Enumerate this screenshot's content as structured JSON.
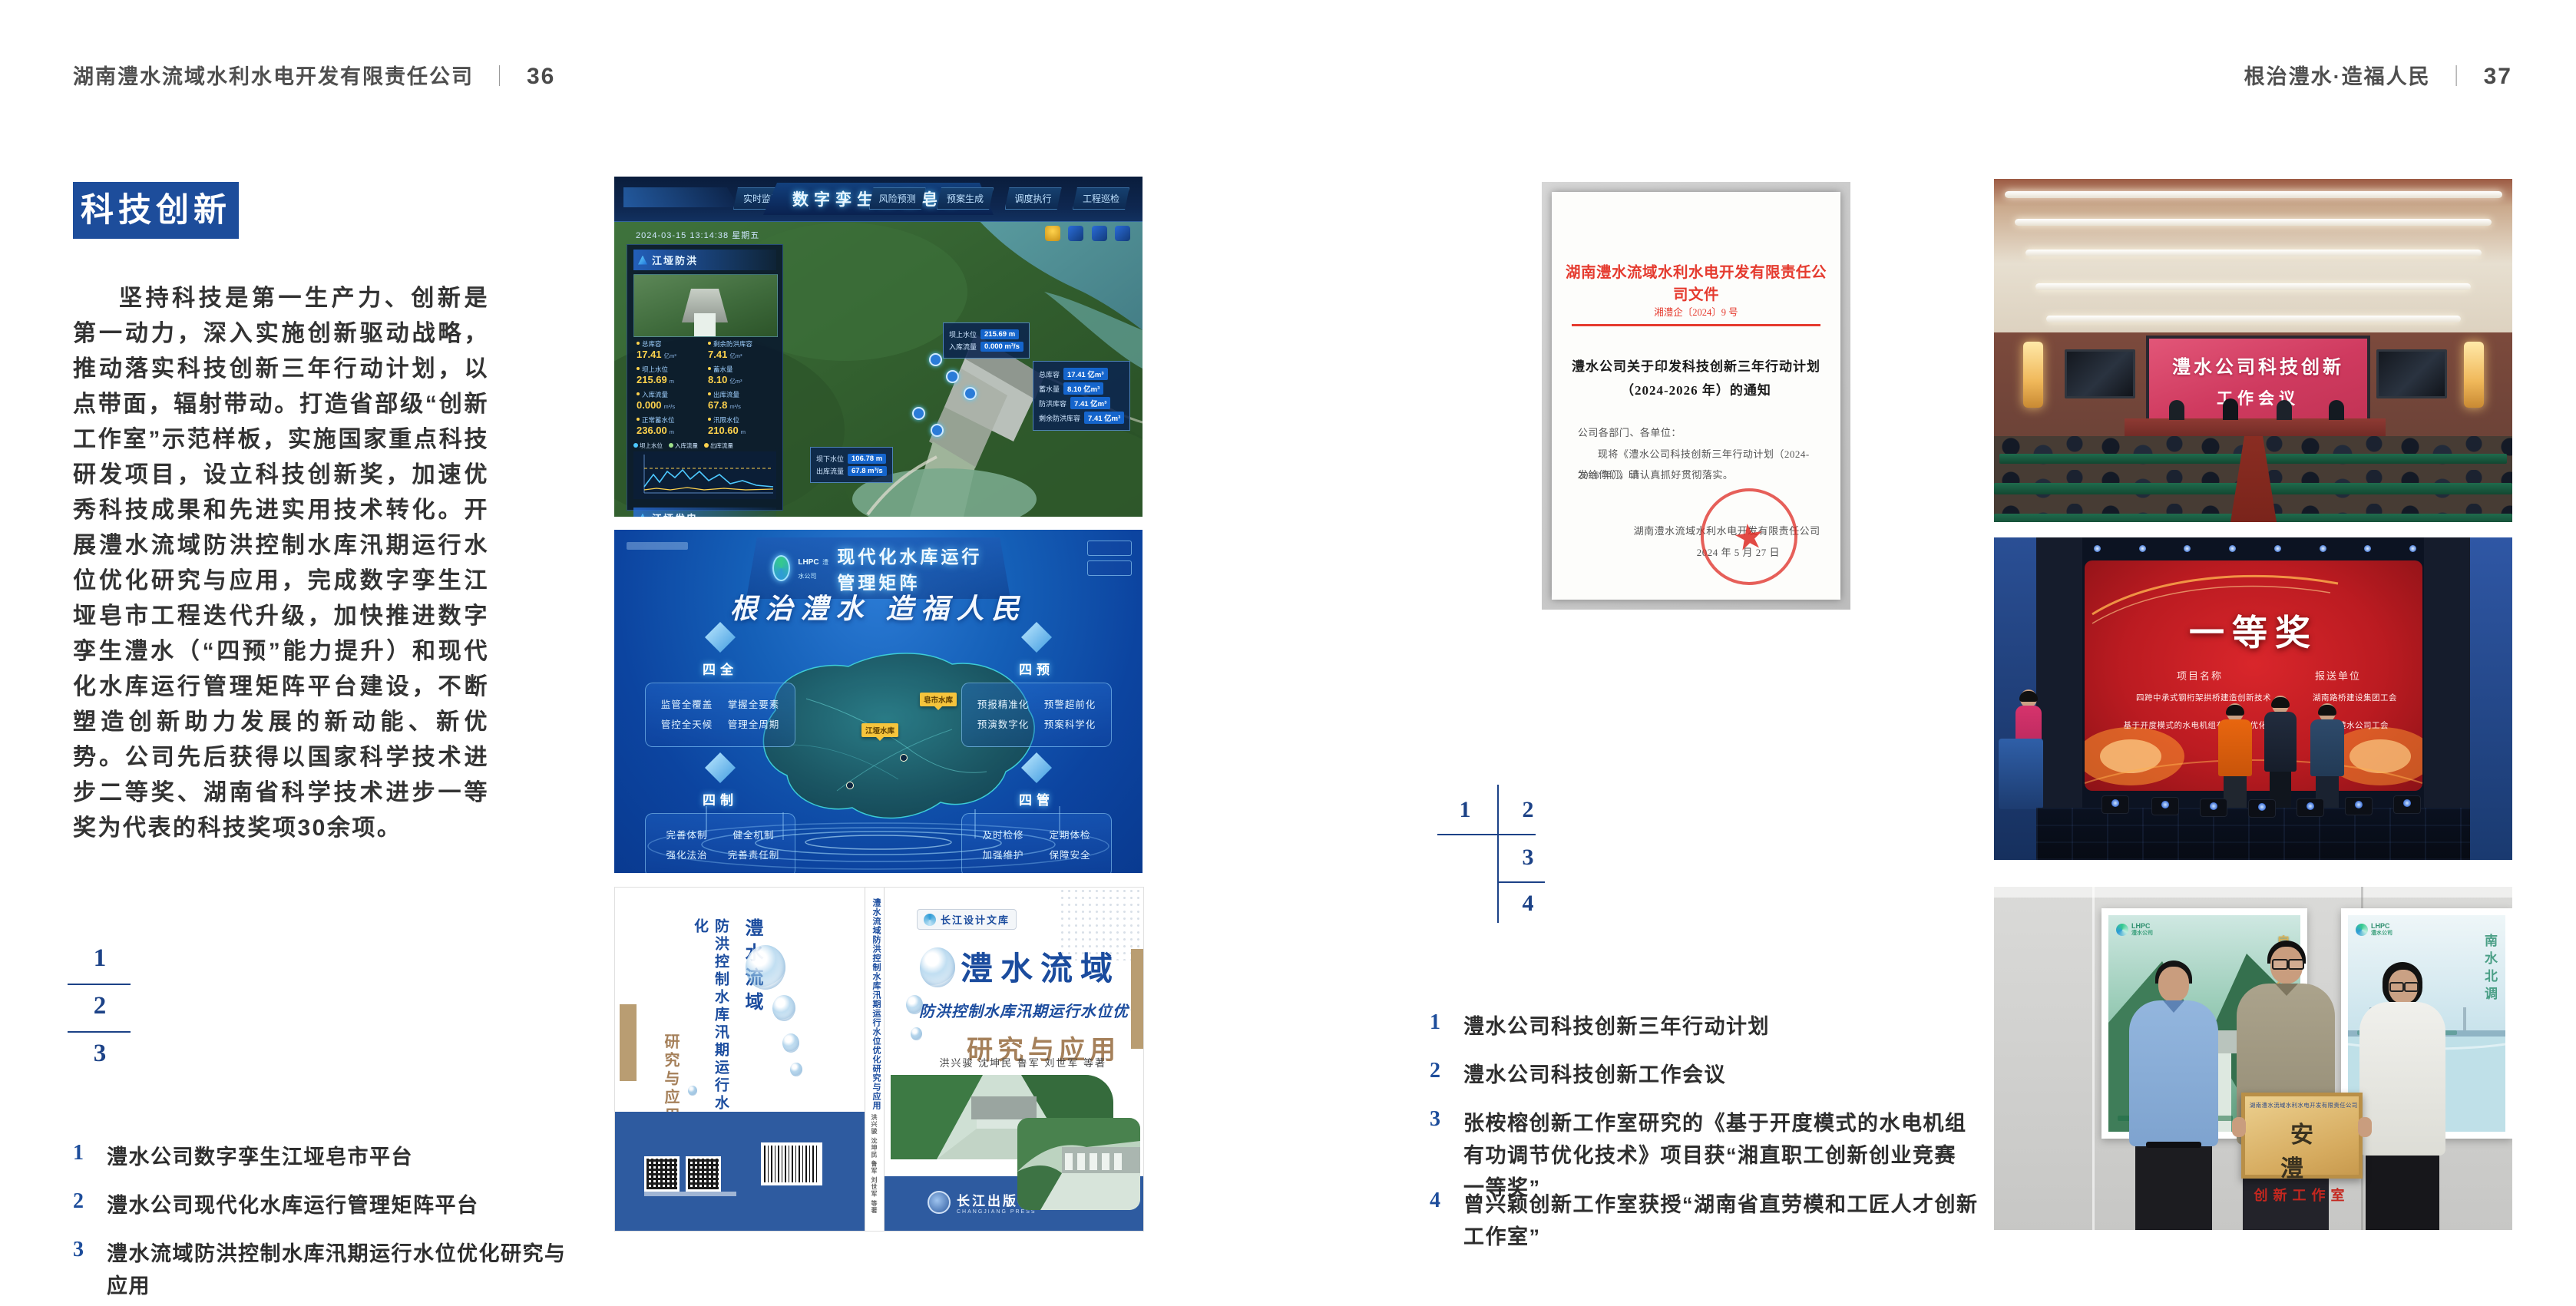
{
  "page_left": {
    "header": {
      "company": "湖南澧水流域水利水电开发有限责任公司",
      "divider": "｜",
      "page_no": "36"
    },
    "section_title": "科技创新",
    "paragraph": "坚持科技是第一生产力、创新是第一动力，深入实施创新驱动战略，推动落实科技创新三年行动计划，以点带面，辐射带动。打造省部级“创新工作室”示范样板，实施国家重点科技研发项目，设立科技创新奖，加速优秀科技成果和先进实用技术转化。开展澧水流域防洪控制水库汛期运行水位优化研究与应用，完成数字孪生江垭皂市工程迭代升级，加快推进数字孪生澧水（“四预”能力提升）和现代化水库运行管理矩阵平台建设，不断塑造创新助力发展的新动能、新优势。公司先后获得以国家科学技术进步二等奖、湖南省科学技术进步一等奖为代表的科技奖项30余项。",
    "figure_numbers": [
      "1",
      "2",
      "3"
    ],
    "captions": [
      {
        "n": "1",
        "t": "澧水公司数字孪生江垭皂市平台"
      },
      {
        "n": "2",
        "t": "澧水公司现代化水库运行管理矩阵平台"
      },
      {
        "n": "3",
        "t": "澧水流域防洪控制水库汛期运行水位优化研究与应用"
      }
    ]
  },
  "page_right": {
    "header": {
      "motto": "根治澧水·造福人民",
      "divider": "｜",
      "page_no": "37"
    },
    "figure_numbers": [
      "1",
      "2",
      "3",
      "4"
    ],
    "captions": [
      {
        "n": "1",
        "t": "澧水公司科技创新三年行动计划"
      },
      {
        "n": "2",
        "t": "澧水公司科技创新工作会议"
      },
      {
        "n": "3",
        "t": "张桉榕创新工作室研究的《基于开度模式的水电机组有功调节优化技术》项目获“湘直职工创新创业竞赛一等奖”"
      },
      {
        "n": "4",
        "t": "曾兴颖创新工作室获授“湖南省直劳模和工匠人才创新工作室”"
      }
    ]
  },
  "dash": {
    "title": "数字孪生江垭皂市",
    "tabs_left": [
      "实时监测",
      "洪水预报",
      "防洪预警"
    ],
    "tabs_right": [
      "风险预测",
      "预案生成",
      "调度执行",
      "工程巡检"
    ],
    "timestamp": "2024-03-15 13:14:38 星期五",
    "flood": {
      "title": "江垭防洪",
      "stats": [
        {
          "l": "总库容",
          "v": "17.41",
          "u": "亿m³"
        },
        {
          "l": "剩余防洪库容",
          "v": "7.41",
          "u": "亿m³"
        },
        {
          "l": "坝上水位",
          "v": "215.69",
          "u": "m"
        },
        {
          "l": "蓄水量",
          "v": "8.10",
          "u": "亿m³"
        },
        {
          "l": "入库流量",
          "v": "0.000",
          "u": "m³/s"
        },
        {
          "l": "出库流量",
          "v": "67.8",
          "u": "m³/s"
        },
        {
          "l": "正常蓄水位",
          "v": "236.00",
          "u": "m"
        },
        {
          "l": "汛限水位",
          "v": "210.60",
          "u": "m"
        }
      ]
    },
    "legend": [
      "坝上水位",
      "入库流量",
      "出库流量"
    ],
    "power": {
      "title": "江垭发电",
      "stats": [
        {
          "l": "年发电计划",
          "v": "6.3000",
          "u": "亿kWh"
        },
        {
          "l": "年累计发电量",
          "v": "1.2907",
          "u": "亿kWh"
        },
        {
          "l": "月累计发电量",
          "v": "3359.21",
          "u": "万kWh"
        },
        {
          "l": "当前出力",
          "v": "0.00",
          "u": "MW"
        },
        {
          "l": "发电流量",
          "v": "0.00",
          "u": "m³/s"
        },
        {
          "l": "弃水流量",
          "v": "0.00",
          "u": "m³/s"
        }
      ],
      "gauges": [
        "1号机组",
        "2号机组",
        "3号机组"
      ]
    },
    "callout_up": [
      {
        "l": "坝上水位",
        "v": "215.69 m"
      },
      {
        "l": "入库流量",
        "v": "0.000 m³/s"
      }
    ],
    "callout_res": [
      {
        "l": "总库容",
        "v": "17.41 亿m³"
      },
      {
        "l": "蓄水量",
        "v": "8.10 亿m³"
      },
      {
        "l": "防洪库容",
        "v": "7.41 亿m³"
      },
      {
        "l": "剩余防洪库容",
        "v": "7.41 亿m³"
      }
    ],
    "callout_down": [
      {
        "l": "坝下水位",
        "v": "106.78 m"
      },
      {
        "l": "出库流量",
        "v": "67.8 m³/s"
      }
    ]
  },
  "matrix": {
    "logo": "LHPC",
    "logo_sub": "澧水公司",
    "title": "现代化水库运行管理矩阵",
    "slogan": "根治澧水 造福人民",
    "groups": [
      {
        "title": "四全",
        "items": [
          "监管全覆盖",
          "掌握全要素",
          "管控全天候",
          "管理全周期"
        ]
      },
      {
        "title": "四预",
        "items": [
          "预报精准化",
          "预警超前化",
          "预演数字化",
          "预案科学化"
        ]
      },
      {
        "title": "四制",
        "items": [
          "完善体制",
          "健全机制",
          "强化法治",
          "完善责任制"
        ]
      },
      {
        "title": "四管",
        "items": [
          "及时检修",
          "定期体检",
          "加强维护",
          "保障安全"
        ]
      }
    ],
    "markers": [
      "皂市水库",
      "江垭水库"
    ]
  },
  "book": {
    "series": "长江设计文库",
    "title1": "澧水流域",
    "title2": "防洪控制水库汛期运行水位优化",
    "title3": "研究与应用",
    "authors": "洪兴骏 沈坤民 鲁军 刘世军 等著",
    "spine": "澧水流域防洪控制水库汛期运行水位优化研究与应用",
    "publisher": "长江出版社",
    "publisher_en": "CHANGJIANG PRESS"
  },
  "doc": {
    "header": "湖南澧水流域水利水电开发有限责任公司文件",
    "doc_no": "湘澧企〔2024〕9 号",
    "title1": "澧水公司关于印发科技创新三年行动计划",
    "title2": "（2024-2026 年）的通知",
    "salutation": "公司各部门、各单位：",
    "body1": "现将《澧水公司科技创新三年行动计划（2024-2026 年）》印",
    "body2": "发给你们，请认真抓好贯彻落实。",
    "signer": "湖南澧水流域水利水电开发有限责任公司",
    "date": "2024 年 5 月 27 日",
    "seal_star": "★"
  },
  "meeting": {
    "screen1": "澧水公司科技创新",
    "screen2": "工作会议"
  },
  "stage": {
    "award": "一等奖",
    "col1": "项目名称",
    "col2": "报送单位",
    "rows": [
      {
        "p": "四跨中承式钢桁架拱桥建造创新技术",
        "u": "湖南路桥建设集团工会"
      },
      {
        "p": "基于开度模式的水电机组有功调节优化技术",
        "u": "湖南澧水公司工会"
      }
    ]
  },
  "plaque": {
    "poster_left_logo": "LHPC",
    "poster_left_sub": "澧水公司",
    "poster_left_v": "皂市水库",
    "poster_right_logo": "LHPC",
    "poster_right_sub": "澧水公司",
    "poster_right_v": "南水北调",
    "board_header": "湖南澧水流域水利水电开发有限责任公司",
    "board_main": "安 澧",
    "board_sub": "创新工作室"
  }
}
